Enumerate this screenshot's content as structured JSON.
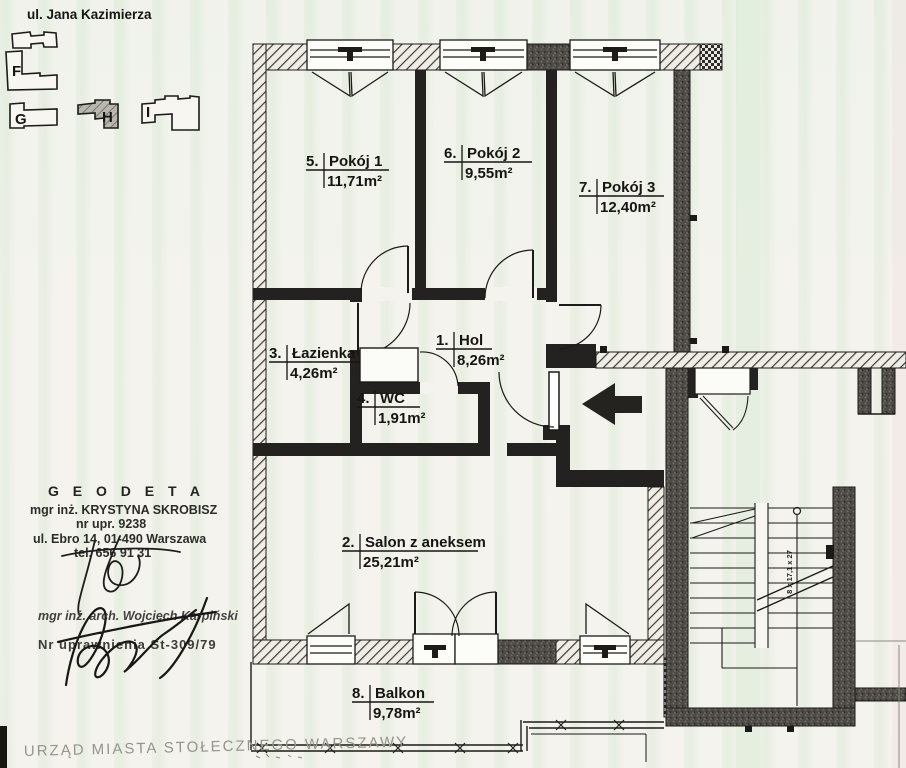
{
  "header": {
    "street": "ul. Jana Kazimierza"
  },
  "site_plan": {
    "buildings": [
      {
        "label": "F"
      },
      {
        "label": "G"
      },
      {
        "label": "H"
      },
      {
        "label": "I"
      }
    ],
    "highlighted_building": "H"
  },
  "rooms": {
    "hol": {
      "number": "1.",
      "name": "Hol",
      "area": "8,26m²"
    },
    "salon": {
      "number": "2.",
      "name": "Salon z aneksem",
      "area": "25,21m²"
    },
    "lazienka": {
      "number": "3.",
      "name": "Łazienka",
      "area": "4,26m²"
    },
    "wc": {
      "number": "4.",
      "name": "WC",
      "area": "1,91m²"
    },
    "pokoj1": {
      "number": "5.",
      "name": "Pokój 1",
      "area": "11,71m²"
    },
    "pokoj2": {
      "number": "6.",
      "name": "Pokój 2",
      "area": "9,55m²"
    },
    "pokoj3": {
      "number": "7.",
      "name": "Pokój 3",
      "area": "12,40m²"
    },
    "balkon": {
      "number": "8.",
      "name": "Balkon",
      "area": "9,78m²"
    }
  },
  "stairs": {
    "dimension_note": "8 x 17,1 x 27"
  },
  "stamps": {
    "geodeta": {
      "title": "G E O D E T A",
      "name": "mgr inż. KRYSTYNA SKROBISZ",
      "license": "nr upr. 9238",
      "address": "ul. Ebro 14, 01-490 Warszawa",
      "phone": "tel. 656 91 31"
    },
    "architect": {
      "name": "mgr inż. arch. Wojciech Karpiński",
      "license": "Nr uprawnienia St-309/79"
    }
  },
  "footer": {
    "office": "URZĄD MIASTA STOŁECZNEGO WARSZAWY"
  },
  "colors": {
    "wall": "#242220",
    "line": "#1b1a18",
    "paper": "#f4f3ee"
  }
}
